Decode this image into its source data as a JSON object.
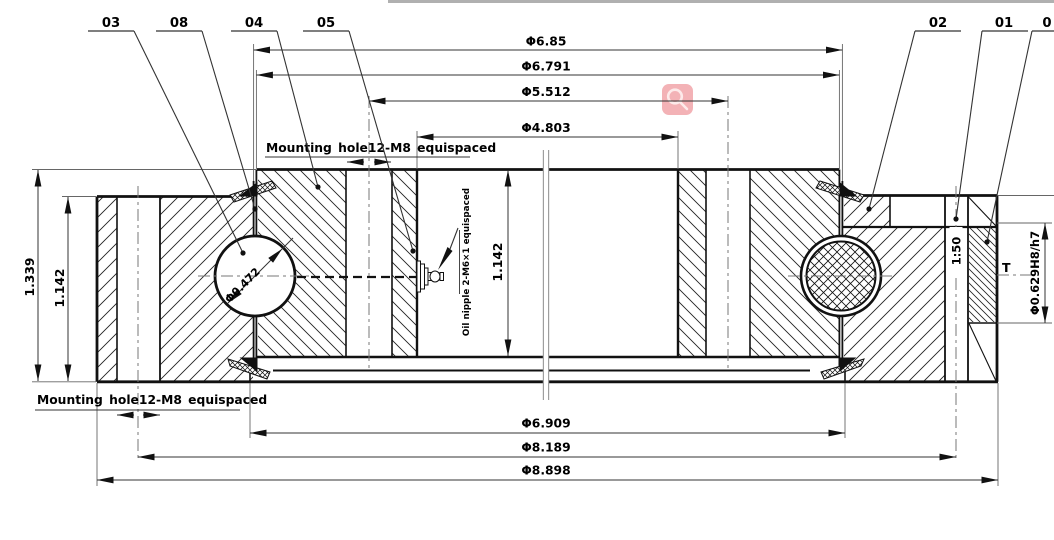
{
  "drawing": {
    "labels": {
      "l03": "03",
      "l08": "08",
      "l04": "04",
      "l05": "05",
      "l02": "02",
      "l01": "01",
      "l0": "0"
    },
    "dims": {
      "d685": "Φ6.85",
      "d6791": "Φ6.791",
      "d5512": "Φ5.512",
      "d4803": "Φ4.803",
      "d6909": "Φ6.909",
      "d8189": "Φ8.189",
      "d8898": "Φ8.898",
      "h_total": "1.339",
      "h_outer": "1.142",
      "h_inner": "1.142",
      "ball": "Φ0.472",
      "taper": "1:50",
      "pin_mark": "T",
      "pin_bore": "Φ0.629H8/h7"
    },
    "notes": {
      "mount_top": "Mounting hole12-M8 equispaced",
      "mount_bottom": "Mounting hole12-M8 equispaced",
      "oil": "Oil nipple 2-M6×1 equispaced"
    },
    "colors": {
      "line": "#111111",
      "aux": "#666666",
      "centerline": "#777777",
      "break": "#9e9e9e"
    }
  },
  "overlay": {
    "zoom_icon": "magnifier",
    "bg": "#f3b2b6",
    "glyph": "#fdeaea",
    "top_strip": "#b0b0b0"
  }
}
